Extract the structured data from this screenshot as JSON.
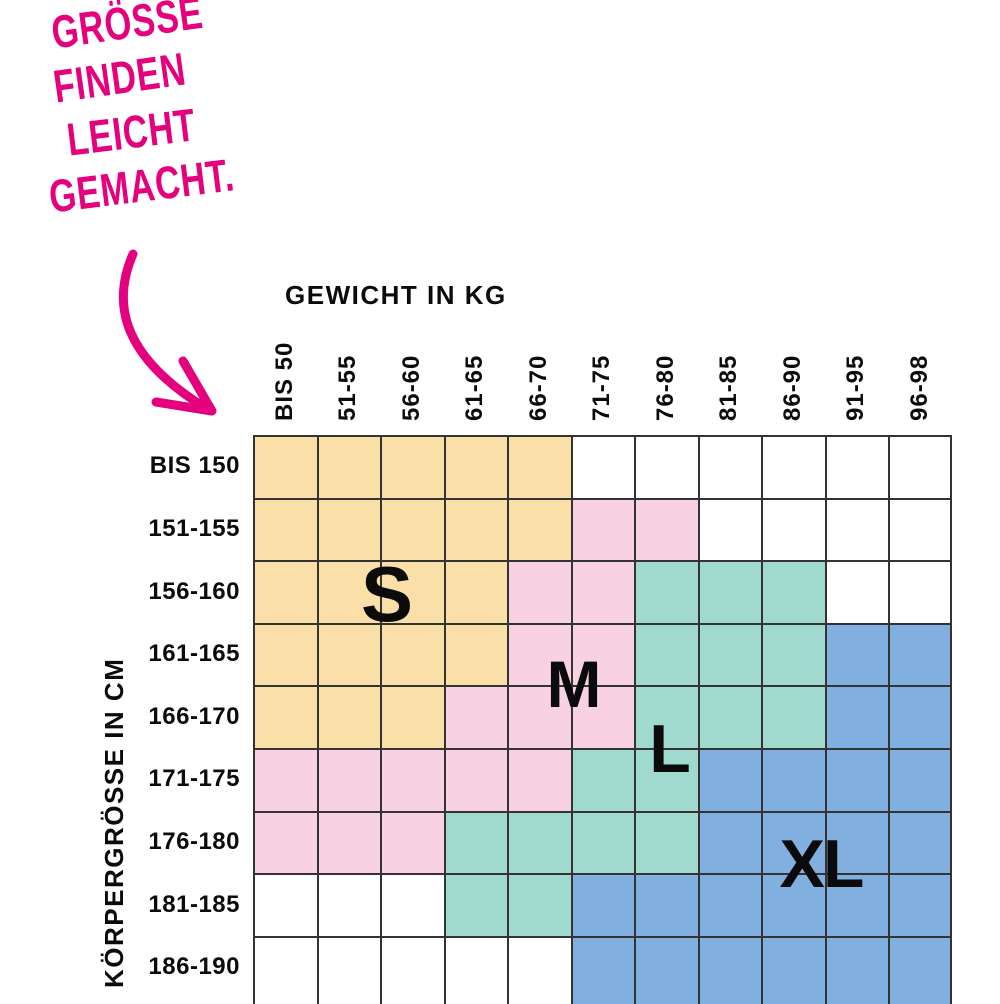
{
  "headline": {
    "lines": [
      "GRÖSSE",
      "FINDEN",
      "LEICHT",
      "GEMACHT."
    ],
    "color": "#E5007D"
  },
  "axes": {
    "x_title": "GEWICHT IN KG",
    "y_title": "KÖRPERGRÖSSE IN CM"
  },
  "sizes": [
    {
      "label": "S",
      "color": "#FADFA8"
    },
    {
      "label": "M",
      "color": "#F8D1E3"
    },
    {
      "label": "L",
      "color": "#A0D9CD"
    },
    {
      "label": "XL",
      "color": "#81AFE0"
    }
  ],
  "grid_line_color": "#333333",
  "chart_data": {
    "type": "heatmap",
    "title": "GRÖSSE FINDEN LEICHT GEMACHT.",
    "xlabel": "GEWICHT IN KG",
    "ylabel": "KÖRPERGRÖSSE IN CM",
    "x_categories": [
      "BIS 50",
      "51-55",
      "56-60",
      "61-65",
      "66-70",
      "71-75",
      "76-80",
      "81-85",
      "86-90",
      "91-95",
      "96-98"
    ],
    "y_categories": [
      "BIS 150",
      "151-155",
      "156-160",
      "161-165",
      "166-170",
      "171-175",
      "176-180",
      "181-185",
      "186-190"
    ],
    "cells": [
      [
        "S",
        "S",
        "S",
        "S",
        "S",
        "",
        "",
        "",
        "",
        "",
        ""
      ],
      [
        "S",
        "S",
        "S",
        "S",
        "S",
        "M",
        "M",
        "",
        "",
        "",
        ""
      ],
      [
        "S",
        "S",
        "S",
        "S",
        "M",
        "M",
        "L",
        "L",
        "L",
        "",
        ""
      ],
      [
        "S",
        "S",
        "S",
        "S",
        "M",
        "M",
        "L",
        "L",
        "L",
        "XL",
        "XL"
      ],
      [
        "S",
        "S",
        "S",
        "M",
        "M",
        "M",
        "L",
        "L",
        "L",
        "XL",
        "XL"
      ],
      [
        "M",
        "M",
        "M",
        "M",
        "M",
        "L",
        "L",
        "XL",
        "XL",
        "XL",
        "XL"
      ],
      [
        "M",
        "M",
        "M",
        "L",
        "L",
        "L",
        "L",
        "XL",
        "XL",
        "XL",
        "XL"
      ],
      [
        "",
        "",
        "",
        "L",
        "L",
        "XL",
        "XL",
        "XL",
        "XL",
        "XL",
        "XL"
      ],
      [
        "",
        "",
        "",
        "",
        "",
        "XL",
        "XL",
        "XL",
        "XL",
        "XL",
        "XL"
      ]
    ],
    "legend": {
      "S": "#FADFA8",
      "M": "#F8D1E3",
      "L": "#A0D9CD",
      "XL": "#81AFE0"
    }
  }
}
